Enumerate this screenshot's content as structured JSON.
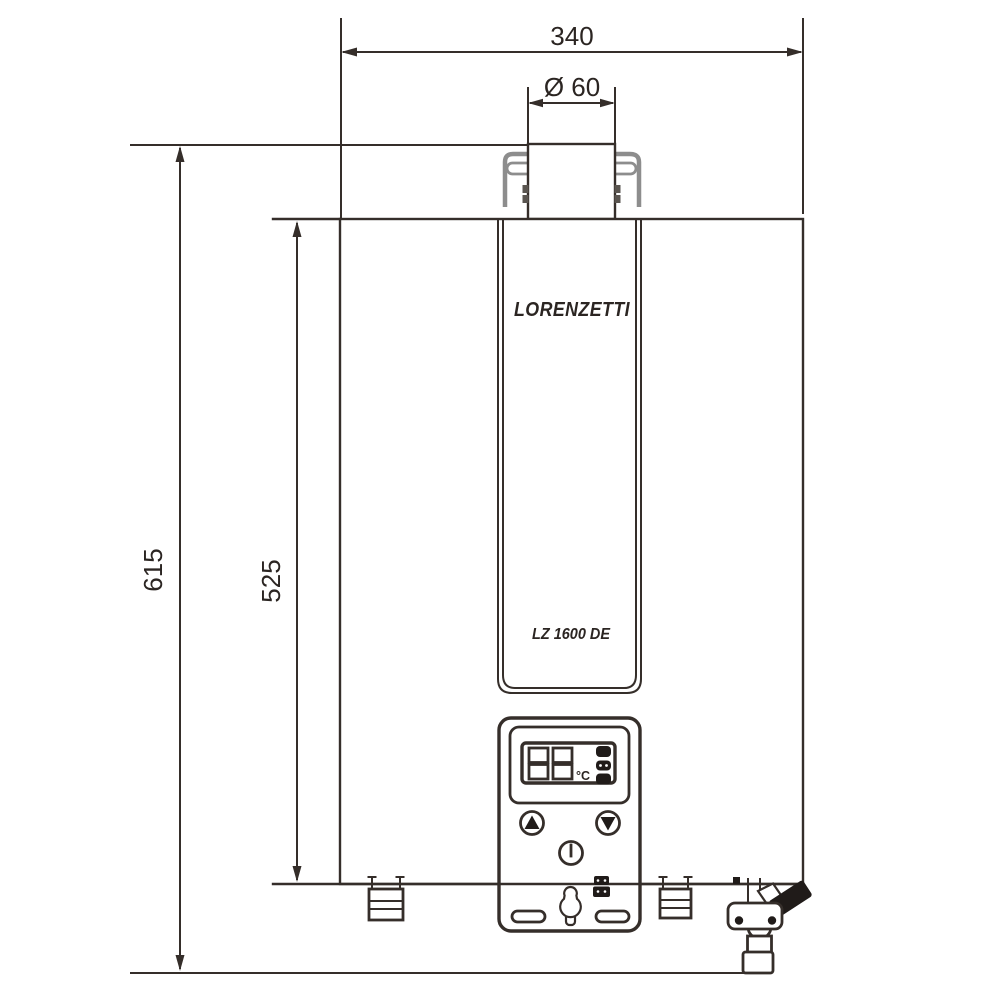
{
  "colors": {
    "background": "#ffffff",
    "line": "#352e2a",
    "solid_black": "#201b19",
    "bracket_gray": "#8d8d8d"
  },
  "dimensions": {
    "width_label": "340",
    "flue_diameter_label": "Ø 60",
    "overall_height_label": "615",
    "cabinet_height_label": "525"
  },
  "product": {
    "brand": "LORENZETTI",
    "model": "LZ 1600 DE",
    "display_unit_label": "°C"
  },
  "icons": {
    "up_button": "up-triangle-button",
    "down_button": "down-triangle-button",
    "power_button": "power-button"
  }
}
